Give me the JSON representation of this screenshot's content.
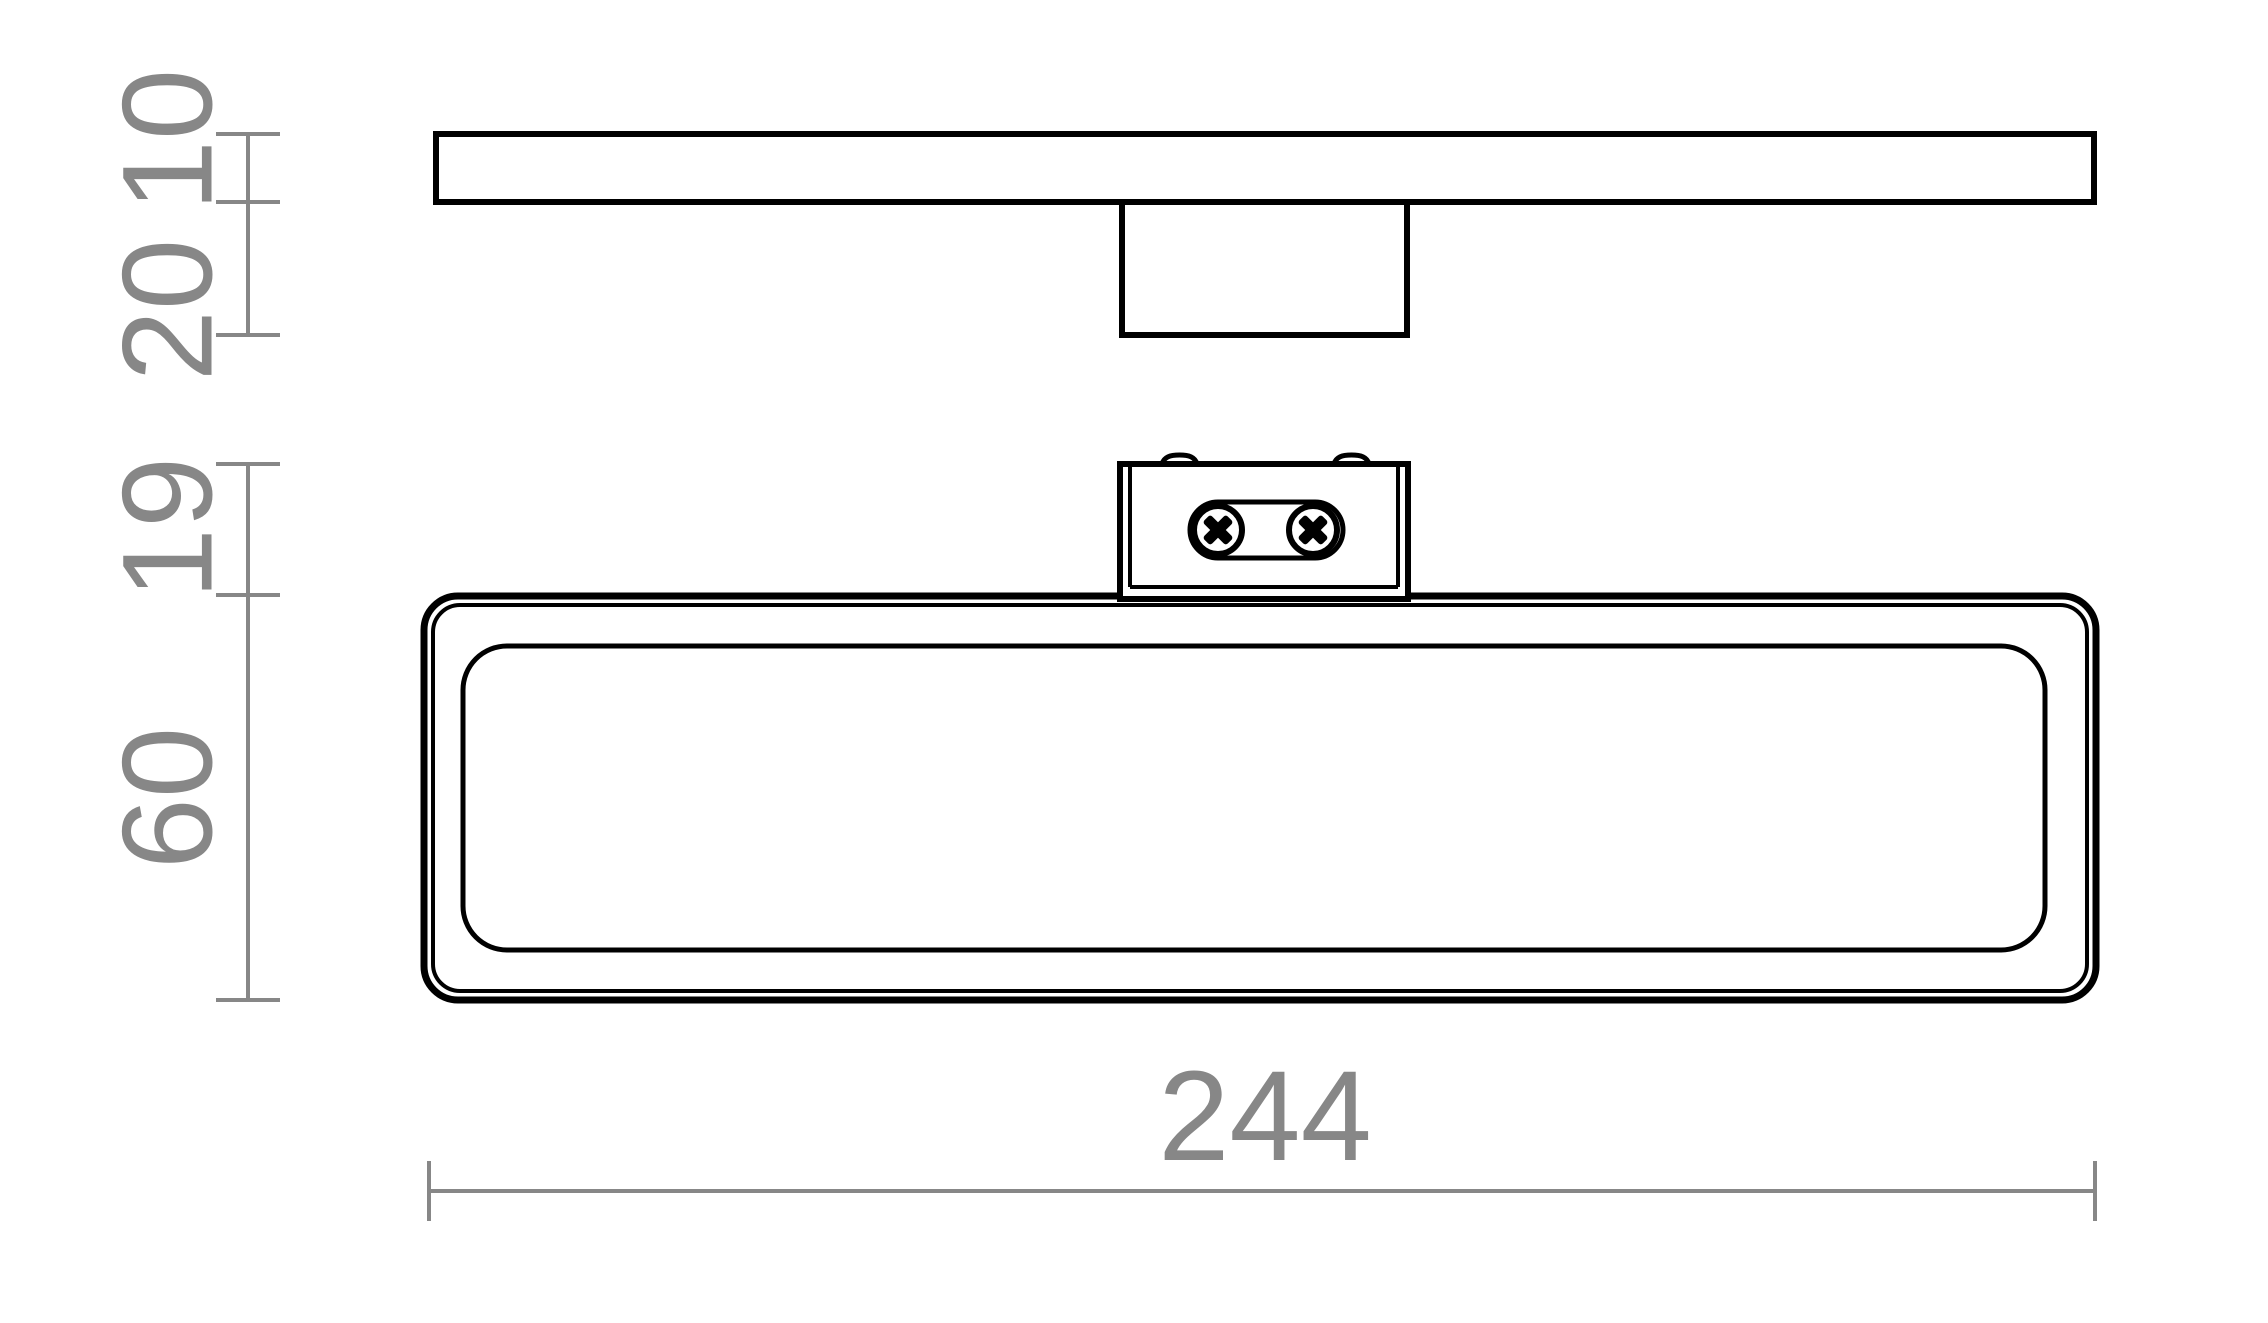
{
  "page": {
    "background": "#ffffff",
    "outline_color": "#000000",
    "dimension_color": "#878787"
  },
  "dimensions": {
    "left_chain": [
      {
        "label": "10"
      },
      {
        "label": "20"
      },
      {
        "label": "19"
      },
      {
        "label": "60"
      }
    ],
    "bottom_chain": [
      {
        "label": "244"
      }
    ]
  }
}
